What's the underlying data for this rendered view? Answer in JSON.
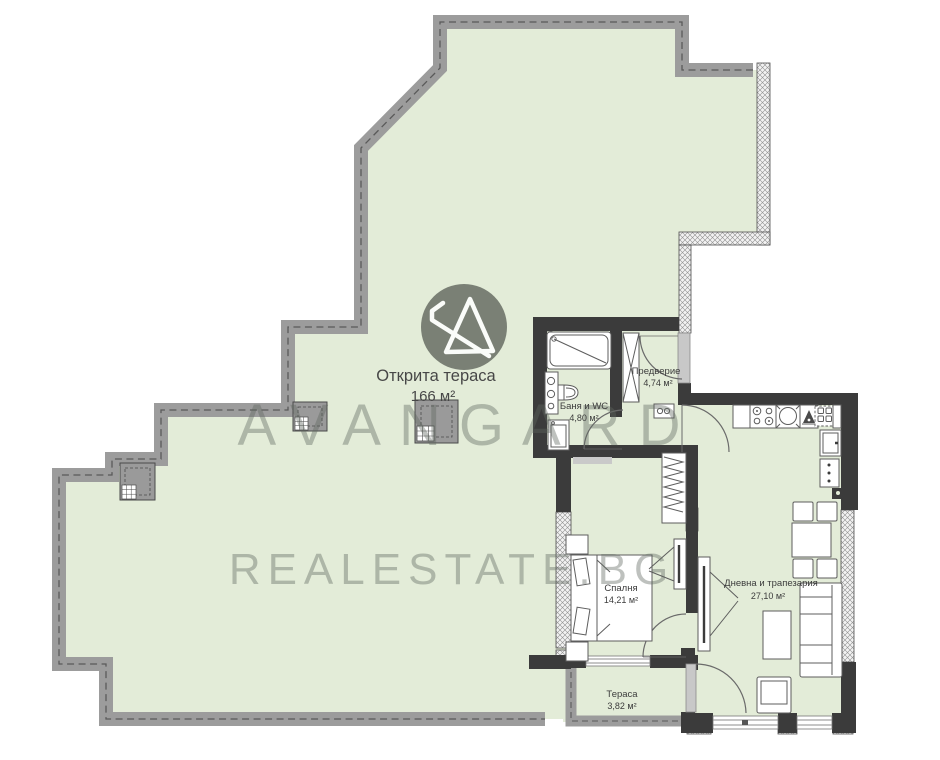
{
  "brand": {
    "name": "AVANGARD",
    "domain": "REALESTATE.BG",
    "logo": "avangard-triangle-logo"
  },
  "rooms": {
    "open_terrace": {
      "name": "Открита тераса",
      "area": "166 м²"
    },
    "bathroom": {
      "name": "Баня и WC",
      "area": "4,80 м²"
    },
    "hallway": {
      "name": "Предверие",
      "area": "4,74 м²"
    },
    "bedroom": {
      "name": "Спалня",
      "area": "14,21 м²"
    },
    "living_dining": {
      "name": "Дневна и трапезария",
      "area": "27,10 м²"
    },
    "terrace": {
      "name": "Тераса",
      "area": "3,82 м²"
    }
  },
  "colors": {
    "floor_green": "#e3ecd8",
    "parapet_gray": "#9c9c9c",
    "wall_dark": "#3b3b3b",
    "watermark_gray": "#5f675f",
    "logo_circle": "#686e64"
  }
}
